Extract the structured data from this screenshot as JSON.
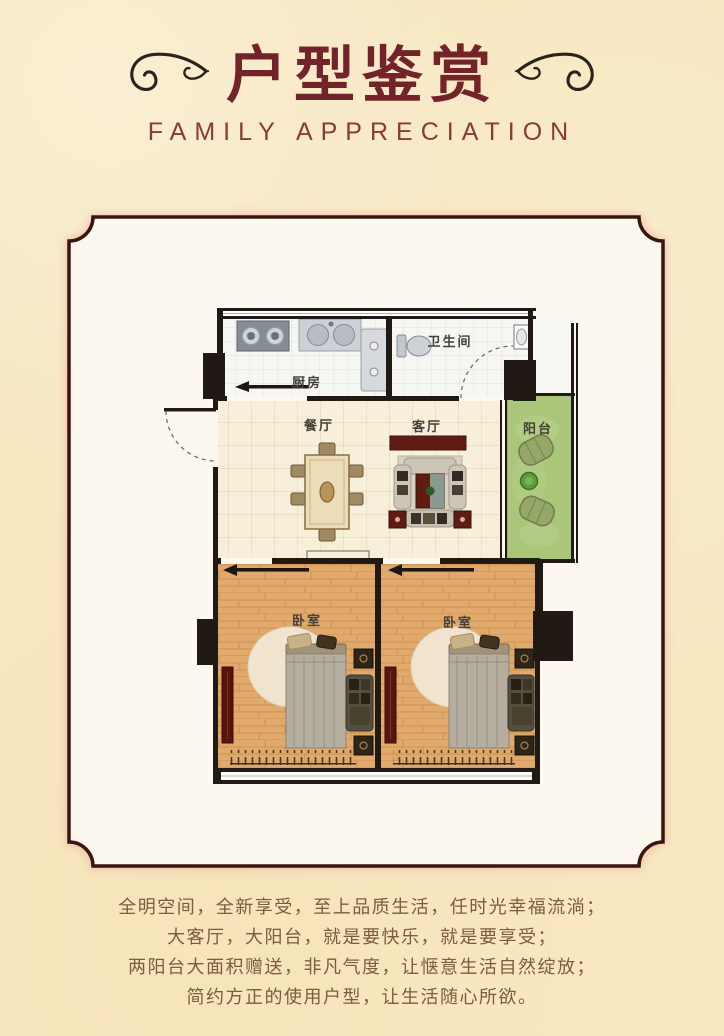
{
  "header": {
    "title": "户型鉴赏",
    "subtitle": "FAMILY APPRECIATION"
  },
  "floorplan": {
    "rooms": {
      "kitchen": "厨房",
      "bathroom": "卫生间",
      "dining": "餐厅",
      "living": "客厅",
      "balcony": "阳台",
      "bedroom_left": "卧室",
      "bedroom_right": "卧室"
    }
  },
  "description": {
    "lines": [
      "全明空间，全新享受，至上品质生活，任时光幸福流淌；",
      "大客厅，大阳台，就是要快乐，就是要享受；",
      "两阳台大面积赠送，非凡气度，让惬意生活自然绽放；",
      "简约方正的使用户型，让生活随心所欲。"
    ]
  },
  "colors": {
    "background": "#f8e8c2",
    "title": "#73232a",
    "subtitle": "#8a3a38",
    "frame_border": "#3a1510",
    "frame_fill": "#fcf8f0",
    "body_text": "#7c5c3e",
    "wall": "#211a14",
    "balcony_green": "#abc57b",
    "wood_floor": "#e2a96d",
    "accent_red": "#5e1c12"
  }
}
